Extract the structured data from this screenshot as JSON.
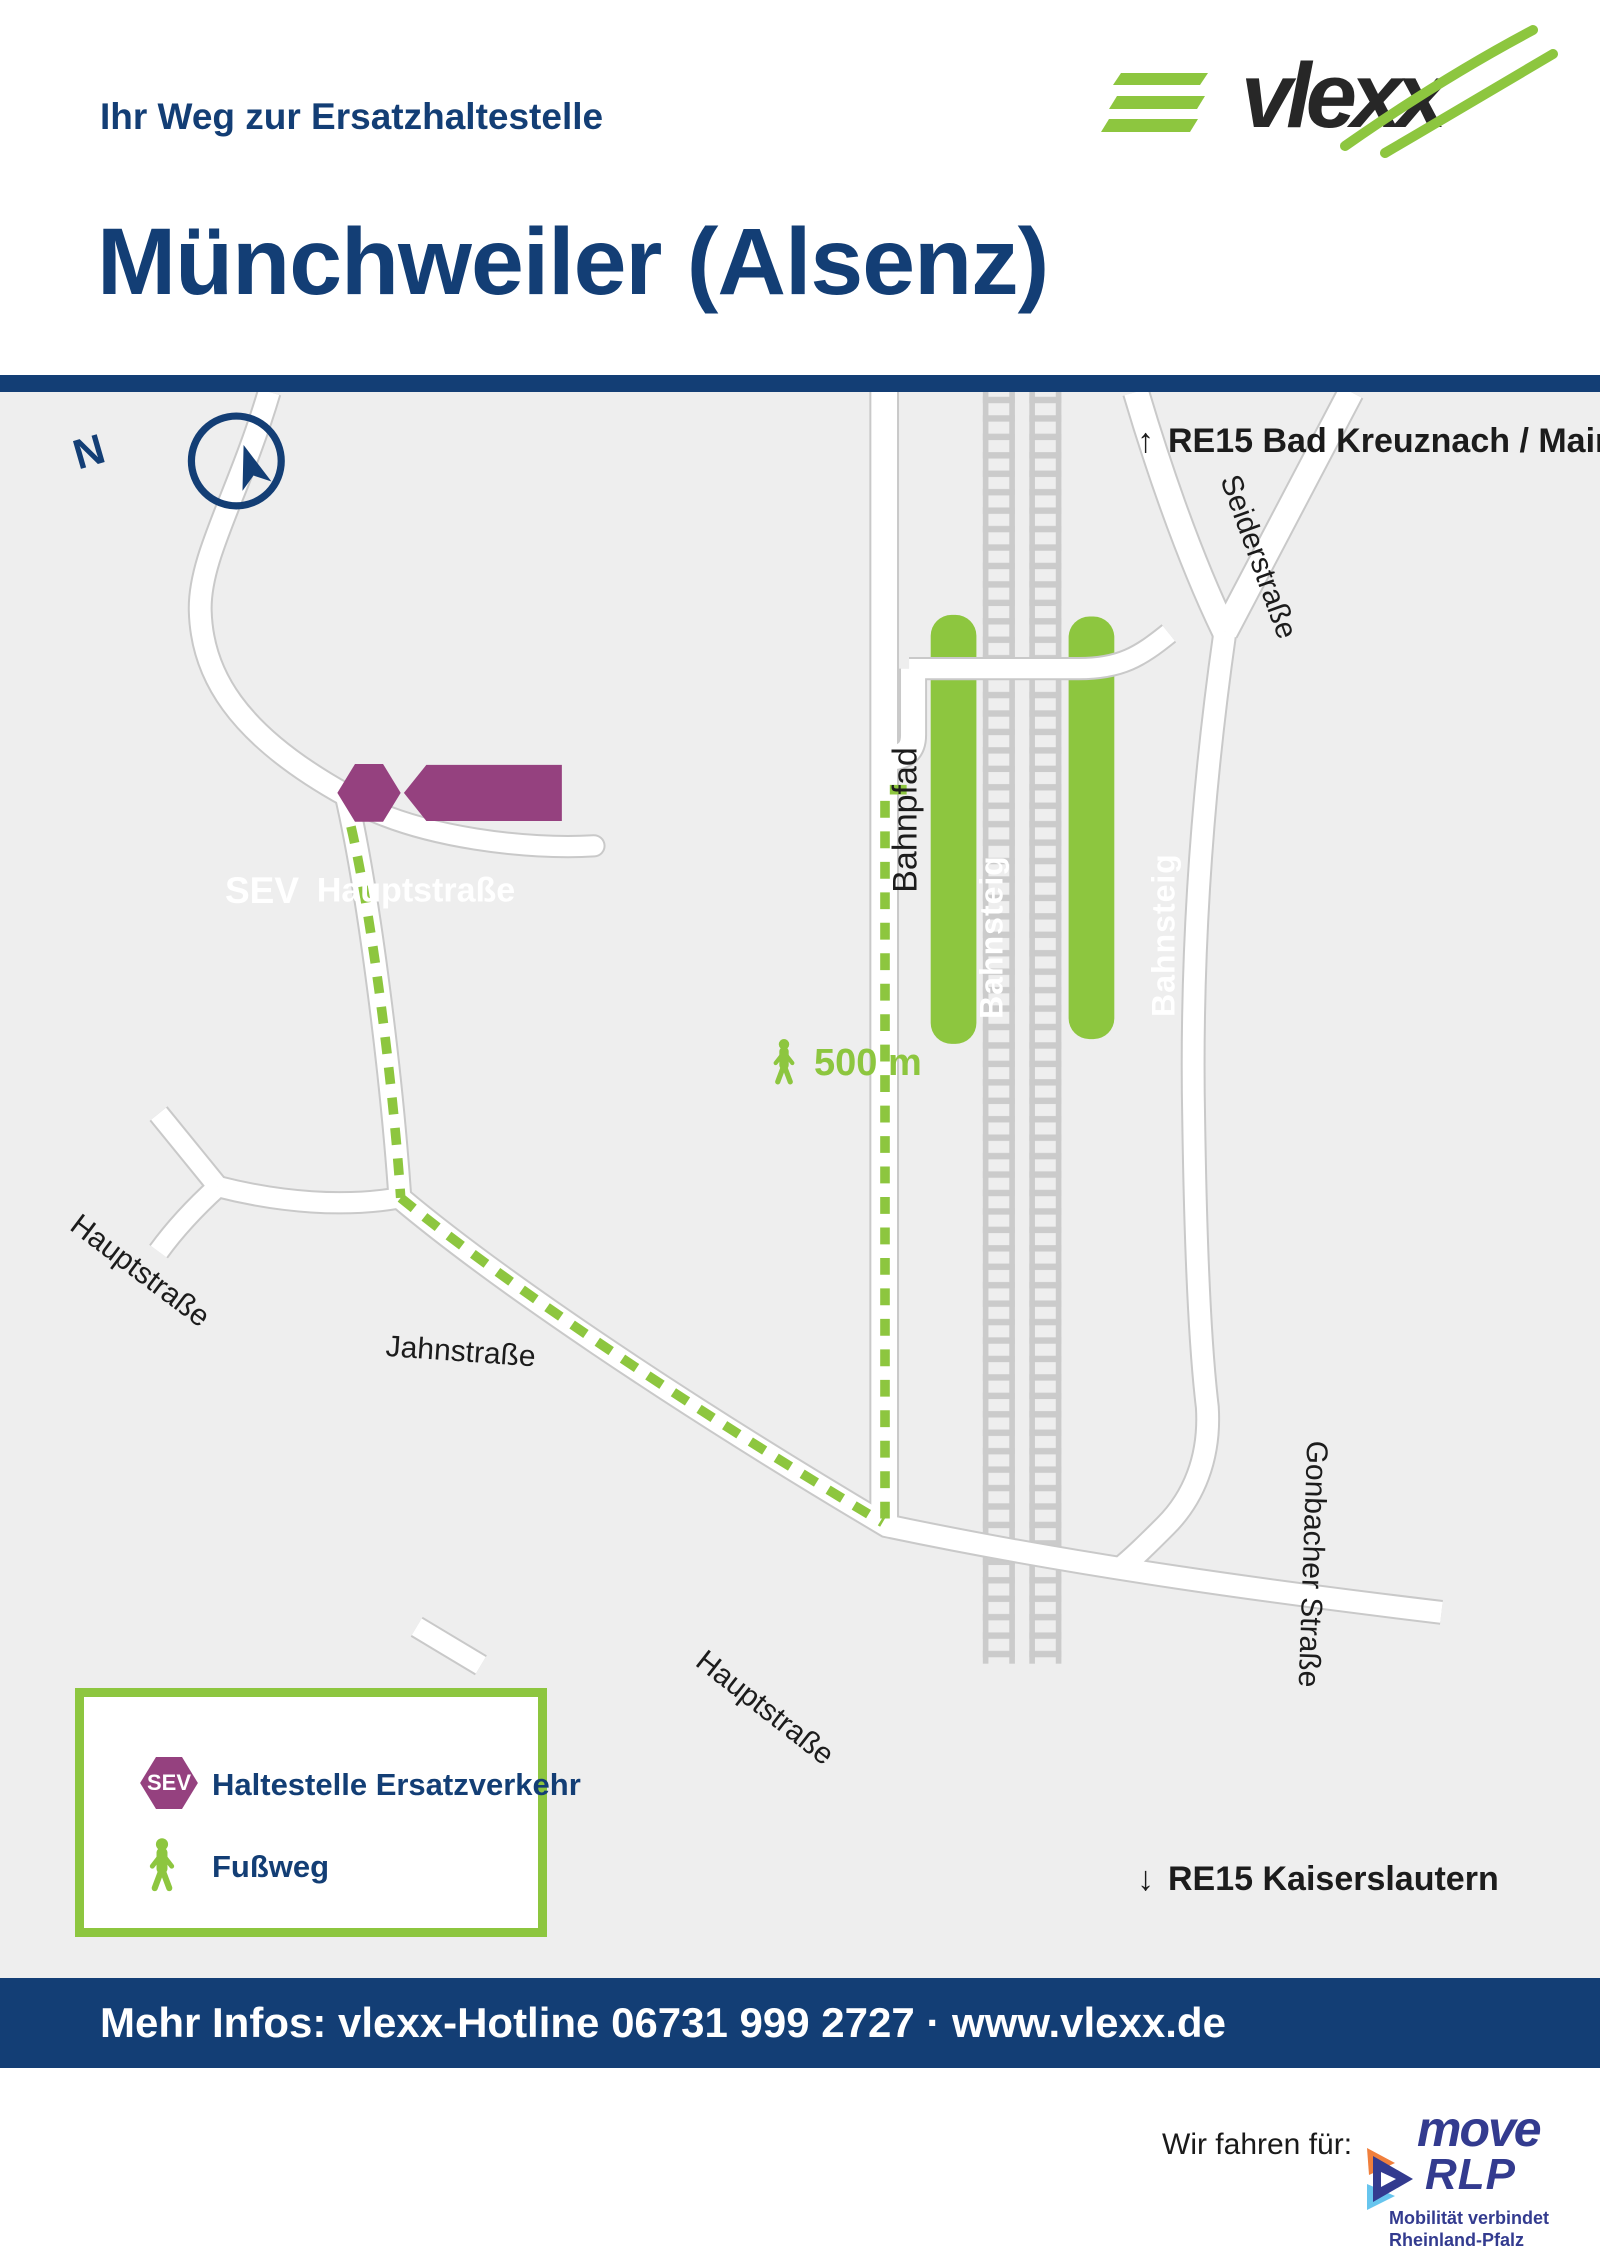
{
  "header": {
    "eyebrow": "Ihr Weg zur Ersatzhaltestelle",
    "title": "Münchweiler (Alsenz)"
  },
  "brand": {
    "name": "vlexx"
  },
  "map": {
    "compass_label": "N",
    "direction_north": {
      "arrow": "↑",
      "label": "RE15 Bad Kreuznach / Mainz"
    },
    "direction_south": {
      "arrow": "↓",
      "label": "RE15 Kaiserslautern"
    },
    "distance": {
      "label": "500 m"
    },
    "streets": {
      "hauptstrasse_upper": "Hauptstraße",
      "jahnstrasse": "Jahnstraße",
      "friedhofstrasse": "Friedhofstraße",
      "hauptstrasse_lower": "Hauptstraße",
      "bahnpfad": "Bahnpfad",
      "seiderstrasse": "Seiderstraße",
      "gonbacher": "Gonbacher Straße"
    },
    "platforms": {
      "left": "Bahnsteig",
      "right": "Bahnsteig"
    },
    "sev_stop": {
      "badge": "SEV",
      "label": "Hauptstraße"
    }
  },
  "legend": {
    "items": [
      {
        "icon": "sev-badge",
        "badge": "SEV",
        "label": "Haltestelle Ersatzverkehr"
      },
      {
        "icon": "walking-person",
        "label": "Fußweg"
      }
    ]
  },
  "infobar": {
    "text": "Mehr Infos: vlexx-Hotline 06731 999 2727 · www.vlexx.de"
  },
  "footer": {
    "tagline": "Wir fahren für:",
    "partner": {
      "line1": "move",
      "line2": "RLP",
      "subline1": "Mobilität verbindet",
      "subline2": "Rheinland-Pfalz"
    }
  },
  "colors": {
    "navy": "#133e75",
    "green": "#8dc63f",
    "purple": "#95417f",
    "road_casing": "#c9c9c9",
    "rail_gray": "#cbcbcb",
    "map_bg": "#eeeeee",
    "move_blue": "#333b8f",
    "move_orange": "#f07f3c",
    "move_lightblue": "#67c5ee"
  }
}
